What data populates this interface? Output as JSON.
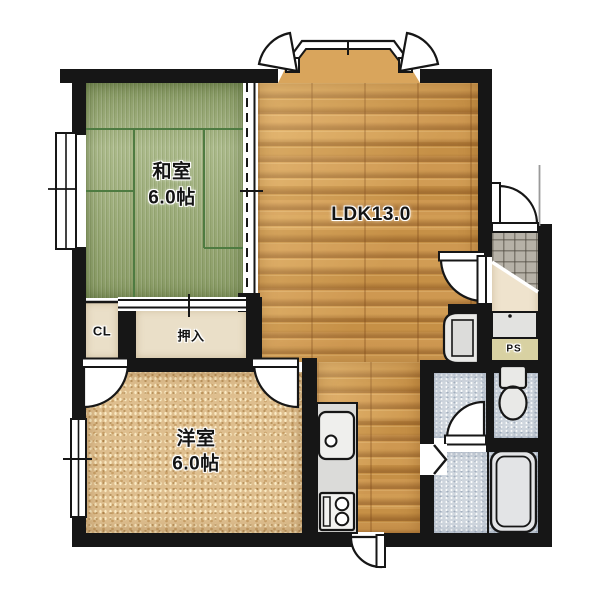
{
  "title": "apartment-floor-plan",
  "rooms": {
    "washitsu": {
      "name": "和室",
      "size": "6.0帖"
    },
    "ldk": {
      "label": "LDK13.0"
    },
    "yoshitsu": {
      "name": "洋室",
      "size": "6.0帖"
    },
    "closet": {
      "label": "CL"
    },
    "oshiire": {
      "label": "押入"
    },
    "pipe_space": {
      "label": "PS"
    }
  },
  "fixtures": [
    "bay-window",
    "casement-window-arcs",
    "entrance-door",
    "shoe-cabinet",
    "wash-basin",
    "toilet",
    "bathtub",
    "kitchen-sink",
    "gas-stove",
    "kitchen-counter",
    "folding-bath-door",
    "balcony-door",
    "sliding-partition",
    "oshiire-sliding-door",
    "side-window",
    "genkan-tile"
  ],
  "colors": {
    "wall": "#161616",
    "wood_floor": "#d3974f",
    "tatami": "#9dae77",
    "carpet": "#debe8e",
    "wet_floor": "#cfd6de",
    "entrance_tile": "#b6b1a7",
    "hallway": "#efe3cd",
    "pipe_space_bg": "#d8d1a2",
    "fixture_fill": "#e9e9e7",
    "tatami_line": "#4e7b41"
  }
}
